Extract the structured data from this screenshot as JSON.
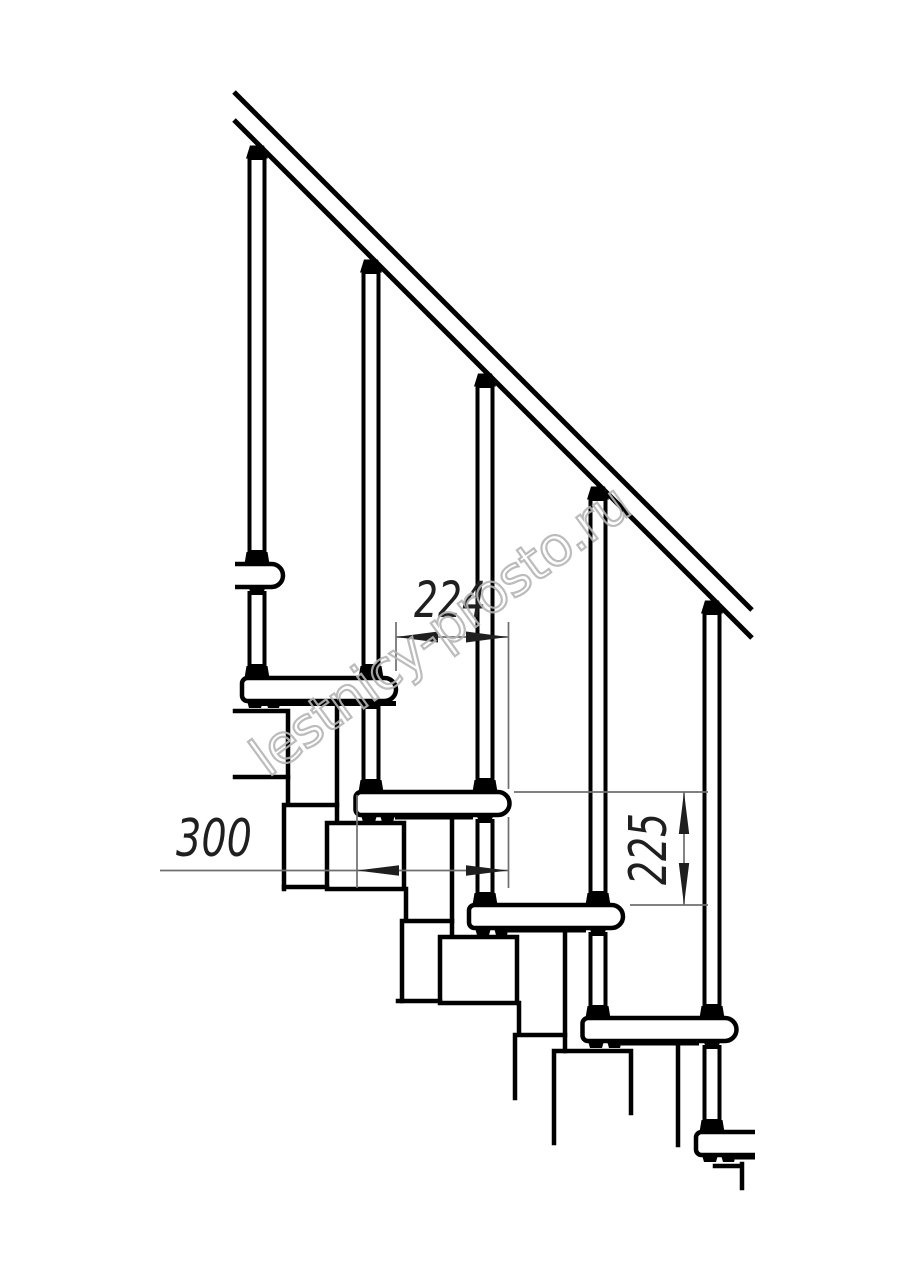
{
  "page": {
    "background": "#ffffff"
  },
  "drawing": {
    "type": "technical-elevation",
    "subject": "modular staircase side view with handrail",
    "ink_color": "#000000",
    "dimension_line_color": "#6f6f6f",
    "dimension_text_color": "#1f1f1f",
    "dimensions": {
      "tread_run": "224",
      "tread_depth": "300",
      "step_rise": "225"
    },
    "watermark": {
      "text": "lestnicy-prosto.ru",
      "color": "#b5b5b5"
    },
    "elements": {
      "treads_visible": 6,
      "balusters": 5,
      "spine_modules": 5,
      "handrail": true
    }
  }
}
